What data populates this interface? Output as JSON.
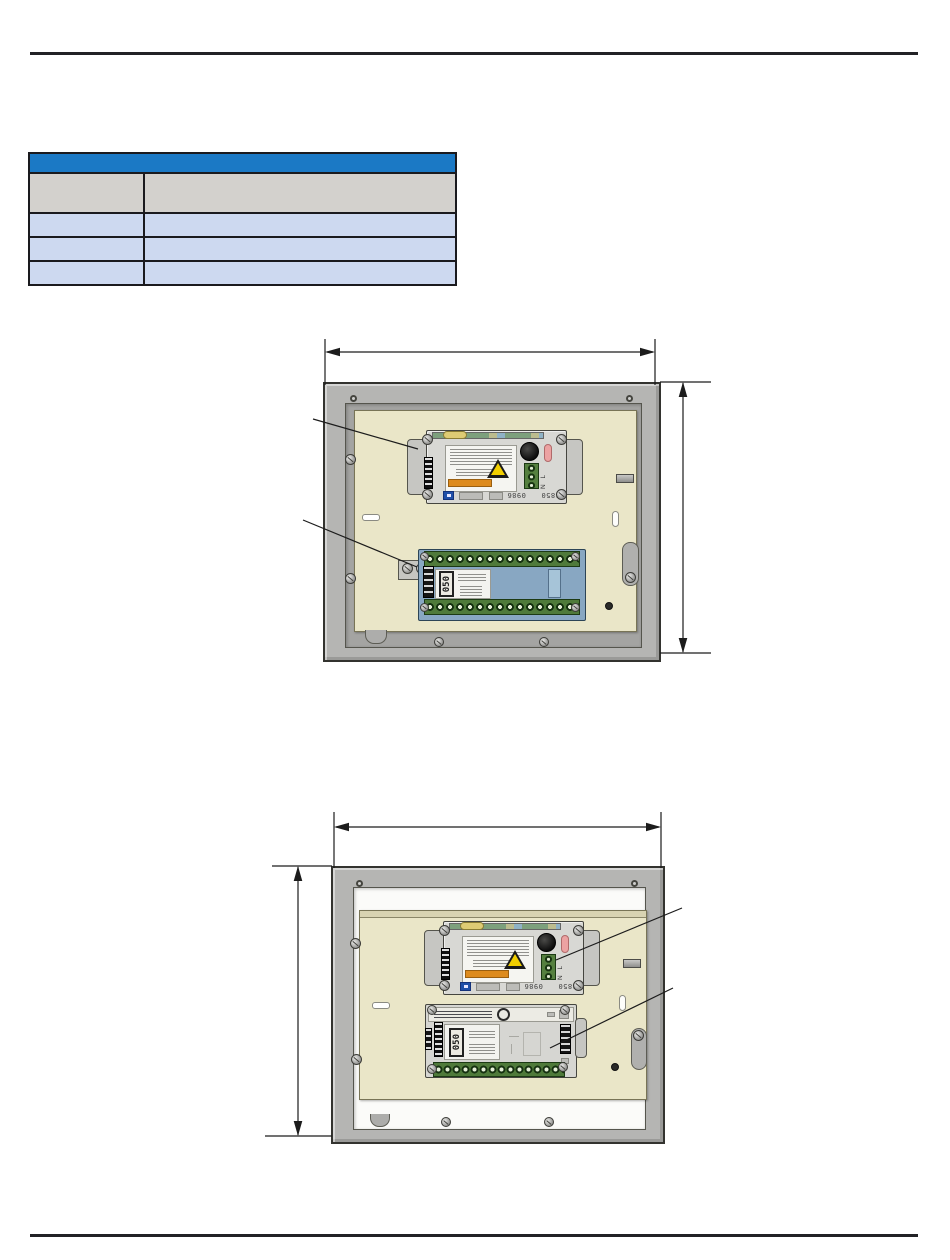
{
  "page": {
    "width": 950,
    "height": 1260,
    "background": "#ffffff",
    "rule_color": "#222226"
  },
  "table": {
    "header": {
      "label": "",
      "bg": "#1b79c5"
    },
    "column_headers": [
      {
        "label": ""
      },
      {
        "label": ""
      }
    ],
    "rows": [
      {
        "col1": "",
        "col2": ""
      },
      {
        "col1": "",
        "col2": ""
      },
      {
        "col1": "",
        "col2": ""
      }
    ],
    "style": {
      "column_header_bg": "#d3d1cd",
      "row_bg": "#cdd9f0",
      "border_color": "#1a1a1e"
    }
  },
  "figure1": {
    "description": "enclosure front view with width and height dimension arrows, two leader callout lines from the left",
    "power_supply_module": {
      "terminal_marking": "N L",
      "code_left": "0986",
      "code_right": "3850"
    },
    "io_module": {
      "display_marking": "050"
    }
  },
  "figure2": {
    "description": "enclosure front view with width dimension on top and height dimension on the left, two leader callout lines from the right",
    "power_supply_module": {
      "terminal_marking": "N L",
      "code_left": "0986",
      "code_right": "3850"
    },
    "io_module": {
      "display_marking": "050"
    }
  },
  "colors": {
    "enclosure_frame": "#b5b5b3",
    "recess_fig1": "#a4a4a2",
    "recess_fig2": "#fbfbf9",
    "backplate": "#eae6c8",
    "module_body": "#d8d8d4",
    "module_tab": "#c6c6c2",
    "board_blue": "#88a7c2",
    "terminal_green": "#4f7a3a",
    "warning_yellow": "#f2cf00",
    "warning_orange": "#dd8b1e",
    "brand_blue": "#1f4fa8",
    "knob_black": "#141414",
    "pink_indicator": "#eca2a2"
  }
}
